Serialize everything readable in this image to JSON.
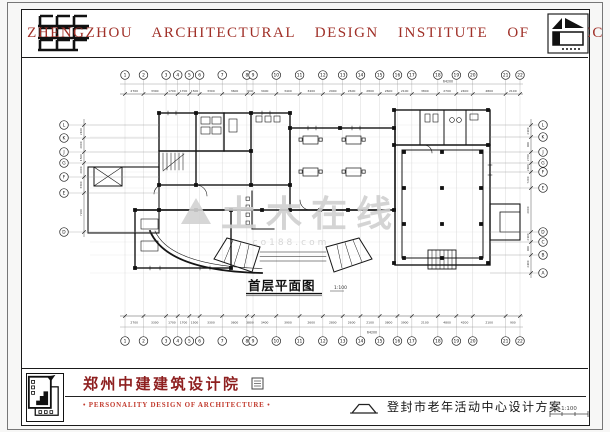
{
  "header": {
    "title": "ZHENGZHOU ARCHITECTURAL DESIGN INSTITUTE OF CSCEC"
  },
  "drawing": {
    "title": "首层平面图",
    "scale": "1:100",
    "total_width_dim": "64200",
    "axes": {
      "top_labels": [
        "1",
        "2",
        "3",
        "4",
        "5",
        "6",
        "7",
        "8",
        "9",
        "10",
        "11",
        "12",
        "13",
        "14",
        "15",
        "16",
        "17",
        "18",
        "19",
        "20",
        "21",
        "22"
      ],
      "top_dims": [
        "2700",
        "3300",
        "1700",
        "1700",
        "1500",
        "3300",
        "3600",
        "900",
        "3400",
        "3400",
        "3400",
        "2900",
        "2600",
        "2800",
        "2600",
        "2100",
        "3800",
        "2700",
        "2400",
        "4800",
        "2100"
      ],
      "bottom_dims": [
        "2700",
        "3300",
        "1700",
        "1700",
        "1500",
        "3300",
        "3600",
        "3800",
        "3400",
        "3900",
        "2600",
        "2800",
        "2600",
        "2100",
        "3800",
        "3900",
        "2100",
        "4800",
        "4200",
        "2100",
        "900"
      ],
      "left_labels": [
        "L",
        "K",
        "J",
        "G",
        "F",
        "E",
        "D"
      ],
      "left_dims": [
        "2100",
        "2000",
        "1500",
        "2000",
        "3300",
        "7200"
      ],
      "right_labels": [
        "L",
        "K",
        "J",
        "G",
        "F",
        "E",
        "D",
        "C",
        "B",
        "A"
      ],
      "right_dims": [
        "2100",
        "900",
        "2700",
        "2400",
        "7200",
        "2000",
        "2100",
        "900",
        "2400"
      ]
    }
  },
  "watermark": {
    "text": "土木在线",
    "subtext": "co188.com"
  },
  "footer": {
    "institute": "郑州中建建筑设计院",
    "slogan": "• PERSONALITY DESIGN OF ARCHITECTURE •",
    "project": "登封市老年活动中心设计方案",
    "scale_note": "1:100"
  }
}
